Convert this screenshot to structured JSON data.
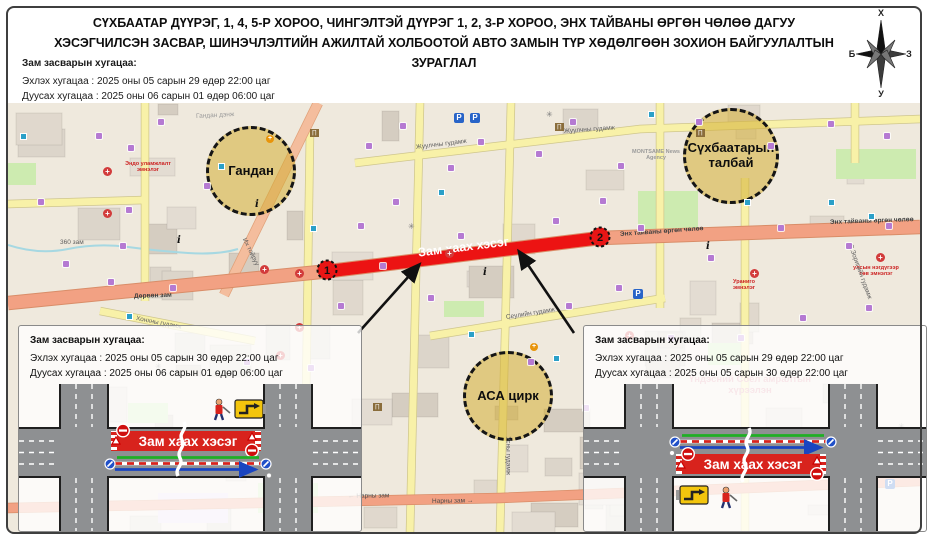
{
  "title": {
    "line1": "СҮХБААТАР ДҮҮРЭГ, 1, 4, 5-Р ХОРОО, ЧИНГЭЛТЭЙ ДҮҮРЭГ 1, 2, 3-Р ХОРОО, ЭНХ ТАЙВАНЫ ӨРГӨН ЧӨЛӨӨ ДАГУУ",
    "line2": "ХЭСЭГЧИЛСЭН ЗАСВАР, ШИНЭЧЛЭЛТИЙН АЖИЛТАЙ ХОЛБООТОЙ АВТО ЗАМЫН ТҮР ХӨДӨЛГӨӨН ЗОХИОН БАЙГУУЛАЛТЫН ЗУРАГЛАЛ"
  },
  "compass": {
    "north": "Х",
    "south": "У",
    "east": "З",
    "west": "Б"
  },
  "schedule_main": {
    "heading": "Зам засварын хугацаа:",
    "start": "Эхлэх хугацаа : 2025 оны 05 сарын 29 өдөр 22:00 цаг",
    "end": "Дуусах хугацаа : 2025 оны 06 сарын 01 өдөр 06:00 цаг"
  },
  "map": {
    "closure": {
      "label": "Зам хаах хэсэг",
      "markers": [
        {
          "n": "1"
        },
        {
          "n": "2"
        }
      ],
      "color": "#ec1313"
    },
    "circles": [
      {
        "label": "Гандан",
        "x": 240,
        "y": 65,
        "r": 42
      },
      {
        "label": "Сүхбаатарын талбай",
        "x": 720,
        "y": 50,
        "r": 45
      },
      {
        "label": "АСА цирк",
        "x": 497,
        "y": 290,
        "r": 42
      }
    ],
    "streets": [
      {
        "name": "Жуулчны гудамж",
        "x": 408,
        "y": 41,
        "rot": -7
      },
      {
        "name": "Жуулчны гудамж",
        "x": 556,
        "y": 25,
        "rot": -4
      },
      {
        "name": "Энх тайваны өргөн чөлөө",
        "x": 612,
        "y": 128,
        "rot": -4,
        "b": 1,
        "c": "#3f3f3f"
      },
      {
        "name": "Энх тайваны өргөн чөлөө",
        "x": 822,
        "y": 116,
        "rot": -2,
        "b": 1,
        "c": "#3f3f3f"
      },
      {
        "name": "Дөрвөн зам",
        "x": 126,
        "y": 190,
        "rot": -2,
        "b": 1,
        "c": "#3f3f3f"
      },
      {
        "name": "← Нарны зам",
        "x": 340,
        "y": 390,
        "rot": -1,
        "c": "#4a4a4a"
      },
      {
        "name": "Нарны зам →",
        "x": 424,
        "y": 395,
        "rot": -1,
        "c": "#4a4a4a"
      },
      {
        "name": "Их тойруу",
        "x": 236,
        "y": 132,
        "rot": 64
      },
      {
        "name": "Сеулийн гудамж",
        "x": 498,
        "y": 211,
        "rot": -9
      },
      {
        "name": "Усны гудамж",
        "x": 500,
        "y": 330,
        "rot": 90
      },
      {
        "name": "Хонхны гудамж",
        "x": 128,
        "y": 212,
        "rot": 11
      },
      {
        "name": "360 зам",
        "x": 52,
        "y": 136,
        "rot": 0
      },
      {
        "name": "Гандан дэнж",
        "x": 188,
        "y": 10,
        "rot": -3,
        "c": "#9a9a9a"
      },
      {
        "name": "С.Зоригийн гудамж",
        "x": 842,
        "y": 138,
        "rot": 70
      }
    ],
    "pois": [
      {
        "text": "Эндо уламжлалт эмнэлэг",
        "x": 140,
        "y": 58,
        "w": 66,
        "fs": 5.5,
        "c": "#cc2222"
      },
      {
        "text": "улсын нэгдүгээр төв эмнэлэг",
        "x": 868,
        "y": 162,
        "w": 50,
        "fs": 5.5,
        "c": "#cc2222"
      },
      {
        "text": "Ураниго эмнэлэг",
        "x": 736,
        "y": 176,
        "w": 42,
        "fs": 5.5,
        "c": "#cc2222"
      },
      {
        "text": "MONTSAME News Agency",
        "x": 648,
        "y": 46,
        "w": 48,
        "fs": 5.5,
        "c": "#9a9a9a"
      },
      {
        "text": "Үндэсний Соёл амралтын хүрээлэн",
        "x": 742,
        "y": 272,
        "w": 130,
        "fs": 9.5,
        "c": "#e090a0"
      }
    ],
    "icons": [
      {
        "t": "cart",
        "x": 88,
        "y": 30
      },
      {
        "t": "cart",
        "x": 120,
        "y": 42
      },
      {
        "t": "cart",
        "x": 30,
        "y": 96
      },
      {
        "t": "cart",
        "x": 118,
        "y": 104
      },
      {
        "t": "cart",
        "x": 112,
        "y": 140
      },
      {
        "t": "cart",
        "x": 55,
        "y": 158
      },
      {
        "t": "cart",
        "x": 100,
        "y": 176
      },
      {
        "t": "cart",
        "x": 162,
        "y": 182
      },
      {
        "t": "cart",
        "x": 196,
        "y": 80
      },
      {
        "t": "cart",
        "x": 150,
        "y": 16
      },
      {
        "t": "cart",
        "x": 358,
        "y": 40
      },
      {
        "t": "cart",
        "x": 392,
        "y": 20
      },
      {
        "t": "cart",
        "x": 440,
        "y": 62
      },
      {
        "t": "cart",
        "x": 470,
        "y": 36
      },
      {
        "t": "cart",
        "x": 528,
        "y": 48
      },
      {
        "t": "cart",
        "x": 562,
        "y": 16
      },
      {
        "t": "cart",
        "x": 610,
        "y": 60
      },
      {
        "t": "cart",
        "x": 688,
        "y": 16
      },
      {
        "t": "cart",
        "x": 760,
        "y": 40
      },
      {
        "t": "cart",
        "x": 820,
        "y": 18
      },
      {
        "t": "cart",
        "x": 876,
        "y": 30
      },
      {
        "t": "cart",
        "x": 350,
        "y": 120
      },
      {
        "t": "cart",
        "x": 385,
        "y": 96
      },
      {
        "t": "cart",
        "x": 372,
        "y": 160
      },
      {
        "t": "cart",
        "x": 450,
        "y": 130
      },
      {
        "t": "cart",
        "x": 545,
        "y": 115
      },
      {
        "t": "cart",
        "x": 592,
        "y": 95
      },
      {
        "t": "cart",
        "x": 630,
        "y": 122
      },
      {
        "t": "cart",
        "x": 700,
        "y": 152
      },
      {
        "t": "cart",
        "x": 770,
        "y": 122
      },
      {
        "t": "cart",
        "x": 838,
        "y": 140
      },
      {
        "t": "cart",
        "x": 878,
        "y": 120
      },
      {
        "t": "cart",
        "x": 330,
        "y": 200
      },
      {
        "t": "cart",
        "x": 420,
        "y": 192
      },
      {
        "t": "cart",
        "x": 558,
        "y": 200
      },
      {
        "t": "cart",
        "x": 608,
        "y": 182
      },
      {
        "t": "cart",
        "x": 660,
        "y": 232
      },
      {
        "t": "cart",
        "x": 730,
        "y": 232
      },
      {
        "t": "cart",
        "x": 792,
        "y": 212
      },
      {
        "t": "cart",
        "x": 858,
        "y": 202
      },
      {
        "t": "cart",
        "x": 236,
        "y": 256
      },
      {
        "t": "cart",
        "x": 300,
        "y": 262
      },
      {
        "t": "cart",
        "x": 520,
        "y": 256
      },
      {
        "t": "cart",
        "x": 575,
        "y": 302
      },
      {
        "t": "cart",
        "x": 860,
        "y": 292
      },
      {
        "t": "cross",
        "x": 95,
        "y": 64
      },
      {
        "t": "cross",
        "x": 95,
        "y": 106
      },
      {
        "t": "cross",
        "x": 252,
        "y": 162
      },
      {
        "t": "cross",
        "x": 287,
        "y": 166
      },
      {
        "t": "cross",
        "x": 287,
        "y": 220
      },
      {
        "t": "cross",
        "x": 268,
        "y": 248
      },
      {
        "t": "cross",
        "x": 437,
        "y": 146
      },
      {
        "t": "cross",
        "x": 617,
        "y": 228
      },
      {
        "t": "cross",
        "x": 868,
        "y": 150
      },
      {
        "t": "cross",
        "x": 742,
        "y": 166
      },
      {
        "t": "crossO",
        "x": 522,
        "y": 240
      },
      {
        "t": "crossO",
        "x": 258,
        "y": 32
      },
      {
        "t": "info",
        "x": 169,
        "y": 132
      },
      {
        "t": "info",
        "x": 247,
        "y": 96
      },
      {
        "t": "info",
        "x": 698,
        "y": 138
      },
      {
        "t": "info",
        "x": 475,
        "y": 164
      },
      {
        "t": "bank",
        "x": 302,
        "y": 26
      },
      {
        "t": "bank",
        "x": 547,
        "y": 20
      },
      {
        "t": "bank",
        "x": 688,
        "y": 26
      },
      {
        "t": "bank",
        "x": 365,
        "y": 300
      },
      {
        "t": "park",
        "x": 446,
        "y": 10
      },
      {
        "t": "park",
        "x": 462,
        "y": 10
      },
      {
        "t": "park",
        "x": 625,
        "y": 186
      },
      {
        "t": "park",
        "x": 877,
        "y": 376
      },
      {
        "t": "bus",
        "x": 12,
        "y": 30
      },
      {
        "t": "bus",
        "x": 210,
        "y": 60
      },
      {
        "t": "bus",
        "x": 430,
        "y": 86
      },
      {
        "t": "bus",
        "x": 736,
        "y": 96
      },
      {
        "t": "bus",
        "x": 640,
        "y": 8
      },
      {
        "t": "bus",
        "x": 820,
        "y": 96
      },
      {
        "t": "bus",
        "x": 460,
        "y": 228
      },
      {
        "t": "bus",
        "x": 545,
        "y": 252
      },
      {
        "t": "bus",
        "x": 860,
        "y": 110
      },
      {
        "t": "bus",
        "x": 118,
        "y": 210
      },
      {
        "t": "bus",
        "x": 302,
        "y": 122
      },
      {
        "t": "star",
        "x": 538,
        "y": 8
      },
      {
        "t": "star",
        "x": 400,
        "y": 120
      },
      {
        "t": "star",
        "x": 147,
        "y": 260
      },
      {
        "t": "star",
        "x": 890,
        "y": 320
      }
    ]
  },
  "inset_left": {
    "heading": "Зам засварын хугацаа:",
    "start": "Эхлэх хугацаа : 2025 оны 05 сарын 30 өдөр 22:00 цаг",
    "end": "Дуусах хугацаа : 2025 оны 06 сарын 01 өдөр 06:00 цаг",
    "closure_label": "Зам хаах хэсэг"
  },
  "inset_right": {
    "heading": "Зам засварын хугацаа:",
    "start": "Эхлэх хугацаа : 2025 оны 05 сарын 29 өдөр 22:00 цаг",
    "end": "Дуусах хугацаа : 2025 оны 05 сарын 30 өдөр 22:00 цаг",
    "closure_label": "Зам хаах хэсэг"
  },
  "colors": {
    "closure_red": "#ec1313",
    "highlight_yellow": "#d3ae34",
    "main_road": "#f2a183"
  }
}
